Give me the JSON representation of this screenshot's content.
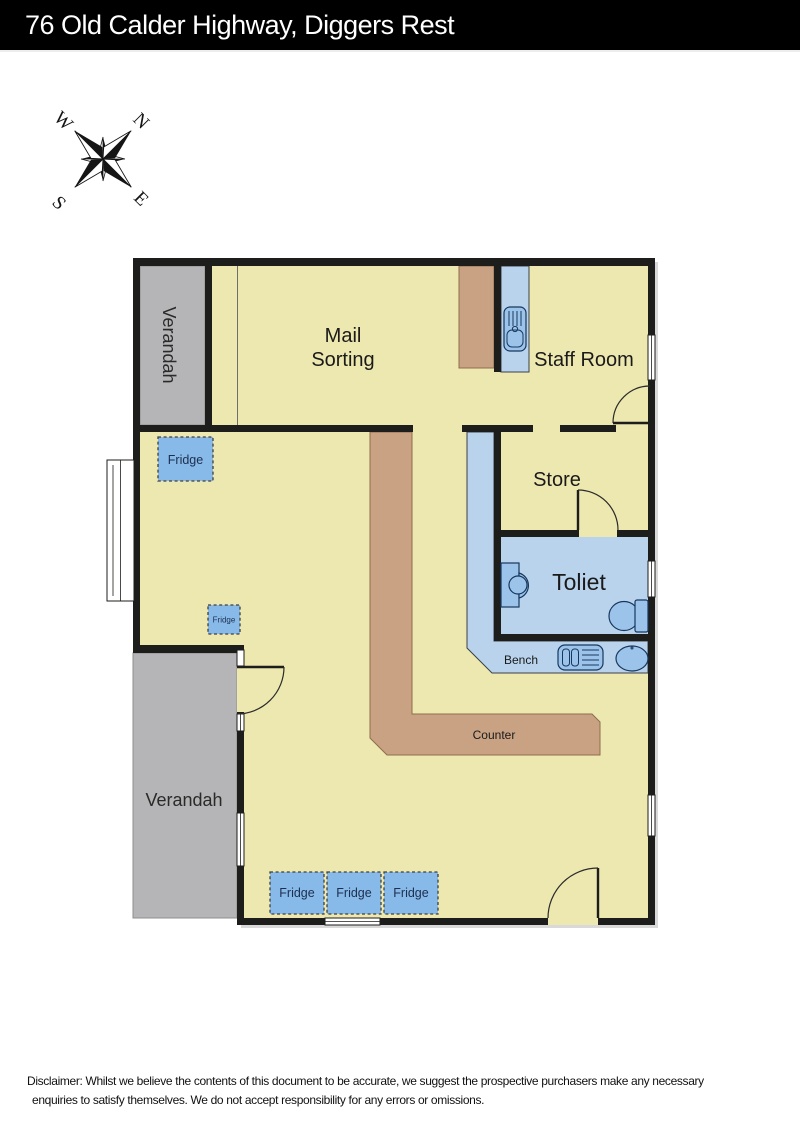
{
  "header": {
    "title": "76 Old Calder Highway, Diggers Rest"
  },
  "compass": {
    "n": "N",
    "e": "E",
    "s": "S",
    "w": "W",
    "icon": "compass-rose-icon"
  },
  "plan": {
    "labels": {
      "verandah_top": "Verandah",
      "mail_line1": "Mail",
      "mail_line2": "Sorting",
      "staff_room": "Staff Room",
      "store": "Store",
      "toilet": "Toliet",
      "bench": "Bench",
      "counter": "Counter",
      "verandah_bottom": "Verandah",
      "fridge": "Fridge"
    },
    "icons": {
      "sink_staffroom": "sink-icon",
      "sink_bench": "sink-icon",
      "round_basin": "basin-icon",
      "pedestal_basin": "hand-basin-icon",
      "toilet_pan": "toilet-icon"
    },
    "colors": {
      "floor": "#EDE7B0",
      "verandah": "#B5B5B7",
      "wall": "#1D1D1B",
      "counter": "#C9A284",
      "counter_border": "#8F6D4E",
      "bench": "#B9D3EC",
      "fridge": "#87B9E9",
      "fixture": "#9CC4EA",
      "fixture_border": "#17375E"
    }
  },
  "disclaimer": {
    "line1": "Disclaimer: Whilst we believe the contents of this document to be accurate, we suggest the prospective purchasers make any necessary",
    "line2": "enquiries to satisfy themselves. We do not accept responsibility for any errors or omissions."
  }
}
